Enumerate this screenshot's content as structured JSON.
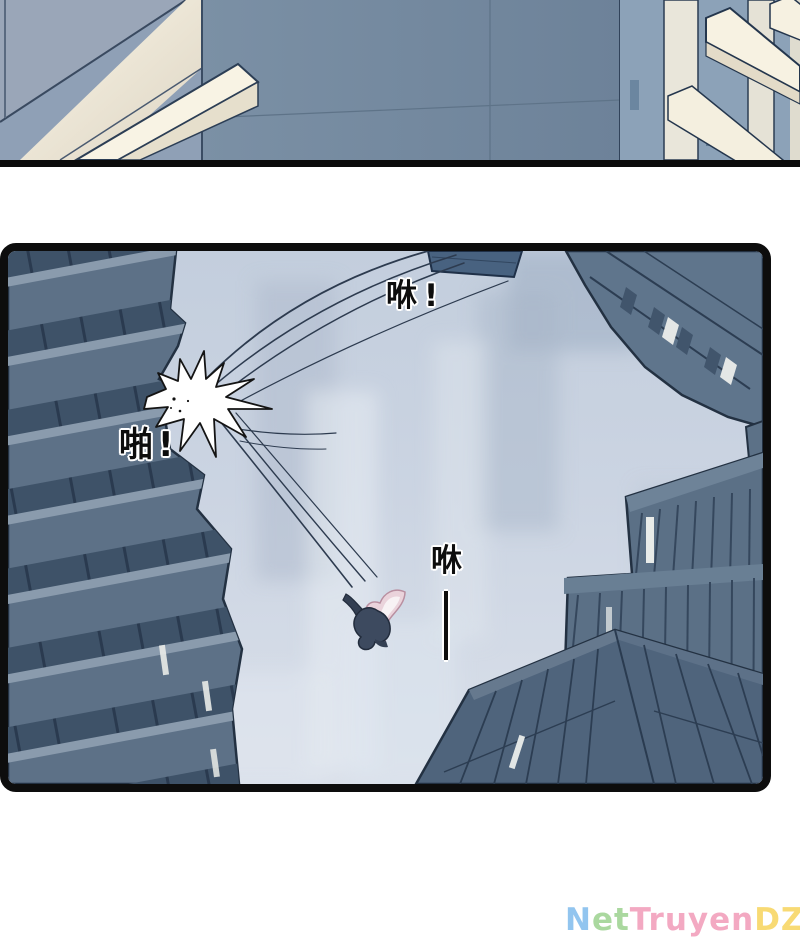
{
  "page": {
    "width": 800,
    "height": 950,
    "background": "#ffffff"
  },
  "panels": {
    "top": {
      "description": "partial cropped panel: building facades seen from below"
    },
    "main": {
      "description": "panel looking straight up between skyscrapers at the sky while a figure falls after an impact"
    }
  },
  "sfx": [
    {
      "id": "whoosh-top",
      "text": "咻!"
    },
    {
      "id": "impact",
      "text": "啪!"
    },
    {
      "id": "whoosh-falling",
      "text": "咻"
    }
  ],
  "watermark": {
    "text": "NetTruyenDZ",
    "parts": [
      {
        "text": "N",
        "color": "#92c5ef"
      },
      {
        "text": "et",
        "color": "#aad89f"
      },
      {
        "text": "Truyen",
        "color": "#f3a9c2"
      },
      {
        "text": "DZ",
        "color": "#f8da74"
      }
    ]
  },
  "colors": {
    "panel_border": "#0d0d0d",
    "sky_top": "#c3cedd",
    "sky_bottom": "#dae0ea",
    "building_face": "#5d7187",
    "building_window_row": "#3e5268",
    "building_ledge": "#8a9bad",
    "building_outline": "#233142",
    "highlight_cream": "#f7f2e2",
    "burst_fill": "#ffffff",
    "hair_pink": "#ead3db",
    "figure_body": "#3d4a5f",
    "sfx_text": "#0d0d0d"
  }
}
